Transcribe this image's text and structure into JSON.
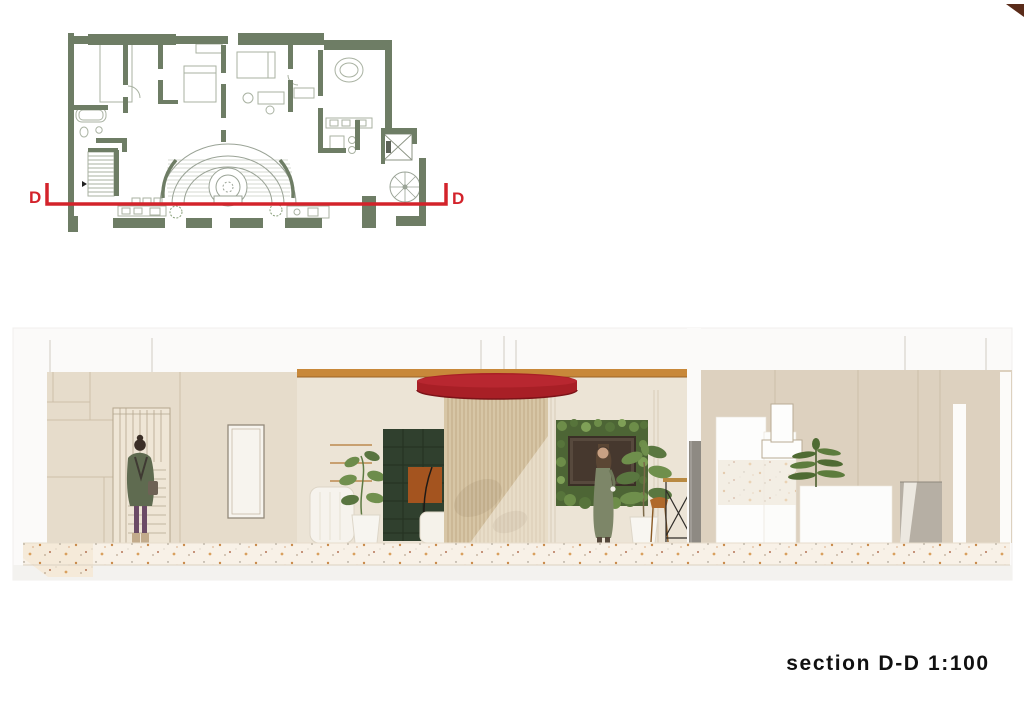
{
  "sheet": {
    "background": "#ffffff"
  },
  "floor_plan": {
    "wall_color": "#6e7d65",
    "furniture_line_color": "#a9b2a2",
    "section_line": {
      "color": "#d3232b",
      "label_left": "D",
      "label_right": "D"
    }
  },
  "section_view": {
    "caption": "section D-D 1:100",
    "palette": {
      "wall_left": "#e6dccb",
      "wall_middle": "#ece4d6",
      "wall_right": "#ddd1bf",
      "wood_beam": "#c8883a",
      "canopy_red": "#a81f26",
      "curtain": "#d7c6a6",
      "bookshelf_green": "#30402e",
      "cabinet_wood": "#a4541f",
      "plant_green": "#6d8c4b",
      "terrazzo_floor": "#f8f1e7",
      "partition_gray": "#8e8a83"
    }
  },
  "corner_marker": {
    "color": "#5a2b19"
  }
}
